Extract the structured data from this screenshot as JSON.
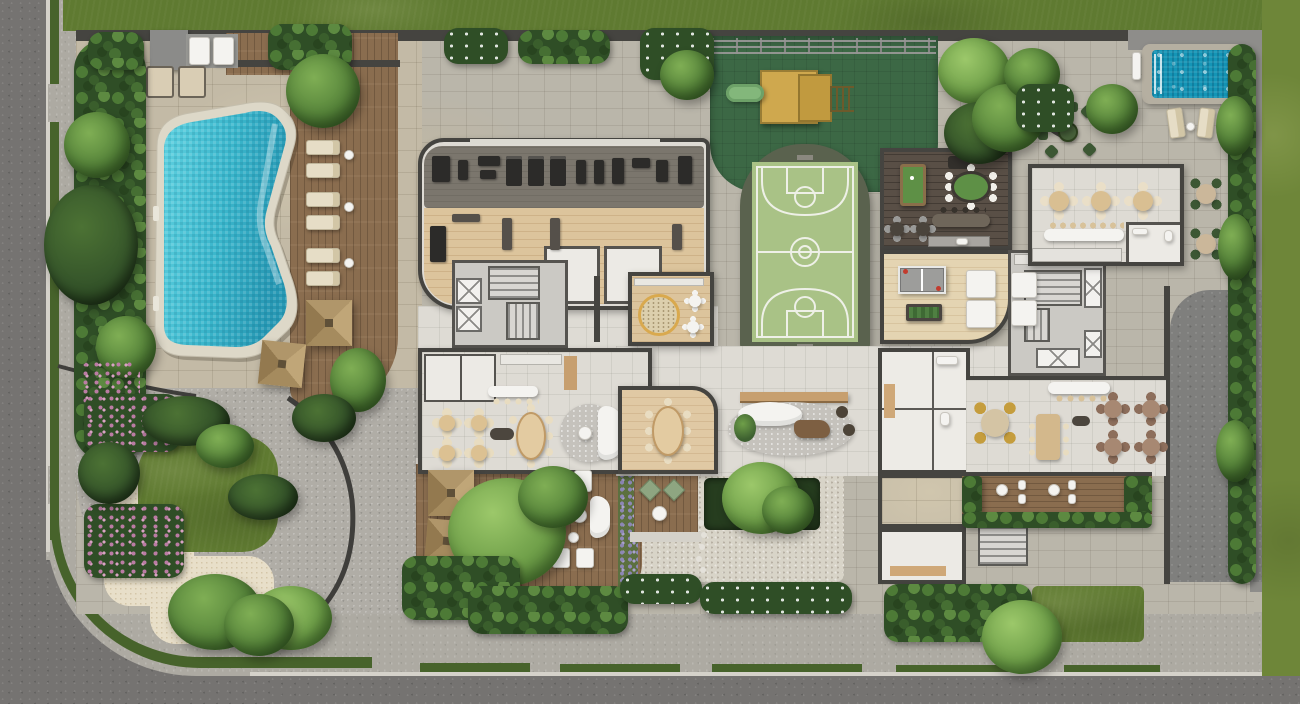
{
  "meta": {
    "type": "architectural-site-plan",
    "description": "Aerial 3D rendering of a residential condominium ground-floor amenities plan (no visible text in image)",
    "canvas": {
      "width": 1300,
      "height": 704
    }
  },
  "palette": {
    "lawn": "#5f7a31",
    "lawnBright": "#6e8639",
    "road": "#757371",
    "sidewalk": "#adaaa2",
    "curb": "#d5d2ca",
    "verge": "#47632b",
    "stone": "#bab6aa",
    "stoneTan": "#c3baa6",
    "gravel": "#b0ada6",
    "terrazzo": "#d8d4c8",
    "sand": "#e8dfc9",
    "floorTile": "#dedbd4",
    "wall": "#454440",
    "deck": "#8a6d4f",
    "woodLight": "#dcc49c",
    "woodDark": "#594f46",
    "water": "#2fb2c9",
    "waterDeep": "#1b93b0",
    "poolCoping": "#ddd8c8",
    "plungePool": "#1495b6",
    "court": "#a9c286",
    "courtFrame": "#5a624e",
    "courtLine": "#eef0e7",
    "playMat": "#3c6845",
    "playWood": "#cfa84e",
    "slide": "#83b77b",
    "billiard": "#5e9046",
    "hedge": "#2f4e26",
    "hedgeLight": "#5d8a41",
    "canopy": "#57853b",
    "canopyLight": "#7fae54",
    "flowerPink": "#bb7ca4",
    "lavender": "#8d87b5",
    "umbrella": "#b0966a",
    "chairBeige": "#e2d4b6",
    "chairGreen": "#3c5733",
    "gold": "#c59d3d",
    "white": "#f4f3f0",
    "dark": "#3a3733",
    "gymMat": "#7b766d",
    "equipment": "#2c2b29",
    "driveway": "#7f7f7d",
    "rug": "#c5c2bc",
    "rugTan": "#dccfad",
    "pingpong": "#9d9d9b",
    "foosball": "#4f7f42"
  },
  "legend": {
    "areas": [
      {
        "name": "main-pool",
        "kind": "free-form mosaic swimming pool"
      },
      {
        "name": "plunge-pool",
        "kind": "small rectangular pool, top-right"
      },
      {
        "name": "pool-deck",
        "kind": "timber deck with 6 sun loungers and 2 pyramid umbrellas"
      },
      {
        "name": "cabana-daybeds",
        "kind": "daybeds at top-left lawn edge"
      },
      {
        "name": "fitness-center",
        "kind": "gym with equipment rows"
      },
      {
        "name": "playground",
        "kind": "green rubber mat with timber play structure and slide"
      },
      {
        "name": "basketball-court",
        "kind": "green sport court with white markings"
      },
      {
        "name": "games-room",
        "kind": "billiards table, oval card table, bar"
      },
      {
        "name": "table-tennis-room",
        "kind": "ping-pong and foosball tables"
      },
      {
        "name": "kids-playroom",
        "kind": "round rug and two activity tables"
      },
      {
        "name": "lobby-lounge",
        "kind": "oval rug, curved sofa, timber console"
      },
      {
        "name": "restaurant-lounge",
        "kind": "four round tables, oval table, counter with stools"
      },
      {
        "name": "private-dining-room",
        "kind": "oval table with eight chairs"
      },
      {
        "name": "main-dining-room",
        "kind": "round and square tables, bar with stools"
      },
      {
        "name": "covered-dining-pavilion",
        "kind": "three round tables, counter, washroom"
      },
      {
        "name": "outdoor-bistro",
        "kind": "patio tables with dark-green chairs"
      },
      {
        "name": "zen-garden",
        "kind": "gravel garden with curved sand path and lawn"
      },
      {
        "name": "lower-deck",
        "kind": "timber deck with umbrellas, loungers and large tree"
      },
      {
        "name": "meditation-deck",
        "kind": "small deck with floor cushions"
      },
      {
        "name": "elevator-cores",
        "kind": "stairs and elevator shafts"
      },
      {
        "name": "service-rooms",
        "kind": "washrooms, storage, support kitchen"
      },
      {
        "name": "driveway",
        "kind": "dark paved service drive, right side"
      },
      {
        "name": "perimeter",
        "kind": "streets, sidewalks, grass verges, hedges, lawns"
      }
    ],
    "counts": {
      "pool-loungers": 6,
      "deck-umbrellas": 4,
      "restaurant-round-tables": 4,
      "covered-dining-tables": 3
    }
  }
}
